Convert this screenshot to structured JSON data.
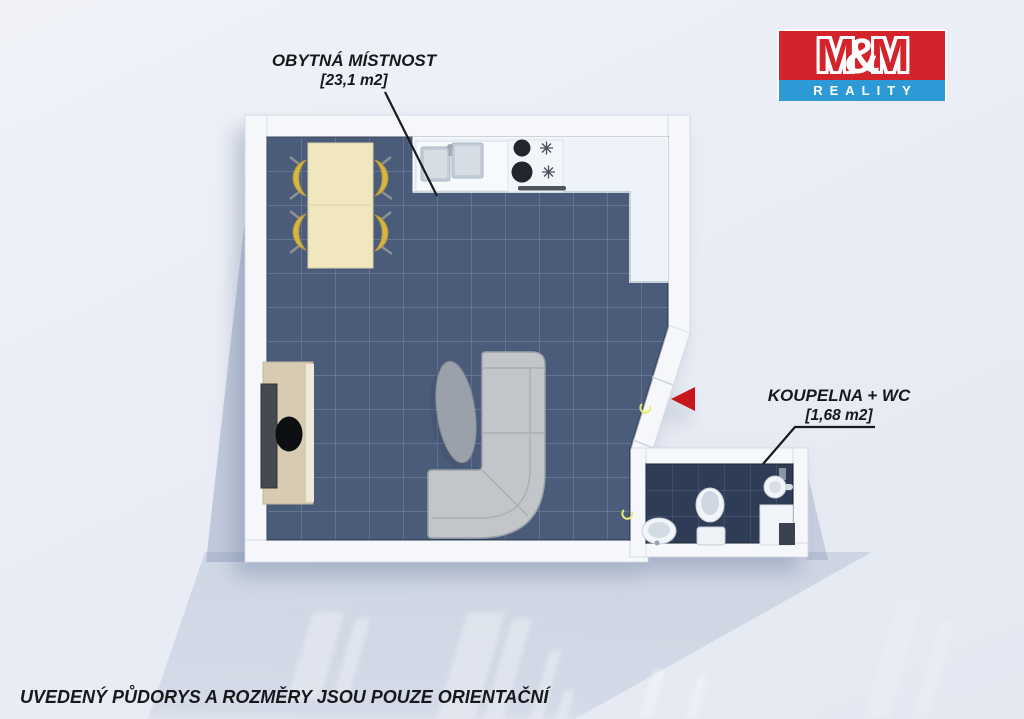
{
  "page": {
    "background_color": "#eaedf5",
    "disclaimer": "UVEDENÝ PŮDORYS A ROZMĚRY JSOU POUZE ORIENTAČNÍ"
  },
  "logo": {
    "m_left": "M",
    "ampersand": "&",
    "m_right": "M",
    "subtitle": "REALITY",
    "red": "#d3232b",
    "blue": "#2d9ad5"
  },
  "rooms": [
    {
      "id": "living-room",
      "label": "OBYTNÁ MÍSTNOST",
      "area": "[23,1 m2]"
    },
    {
      "id": "bathroom-wc",
      "label": "KOUPELNA + WC",
      "area": "[1,68 m2]"
    }
  ],
  "floorplan": {
    "wall_color": "#f5f7fa",
    "main_floor_color": "#4b5c7a",
    "bathroom_floor_color": "#2e3c55",
    "entrance_arrow_color": "#c8161d",
    "furniture": [
      "kitchen-counter",
      "kitchen-sink",
      "stove",
      "dining-table",
      "chairs",
      "corner-sofa",
      "coffee-table",
      "tv-cabinet",
      "toilet",
      "washbasin",
      "shower"
    ]
  }
}
